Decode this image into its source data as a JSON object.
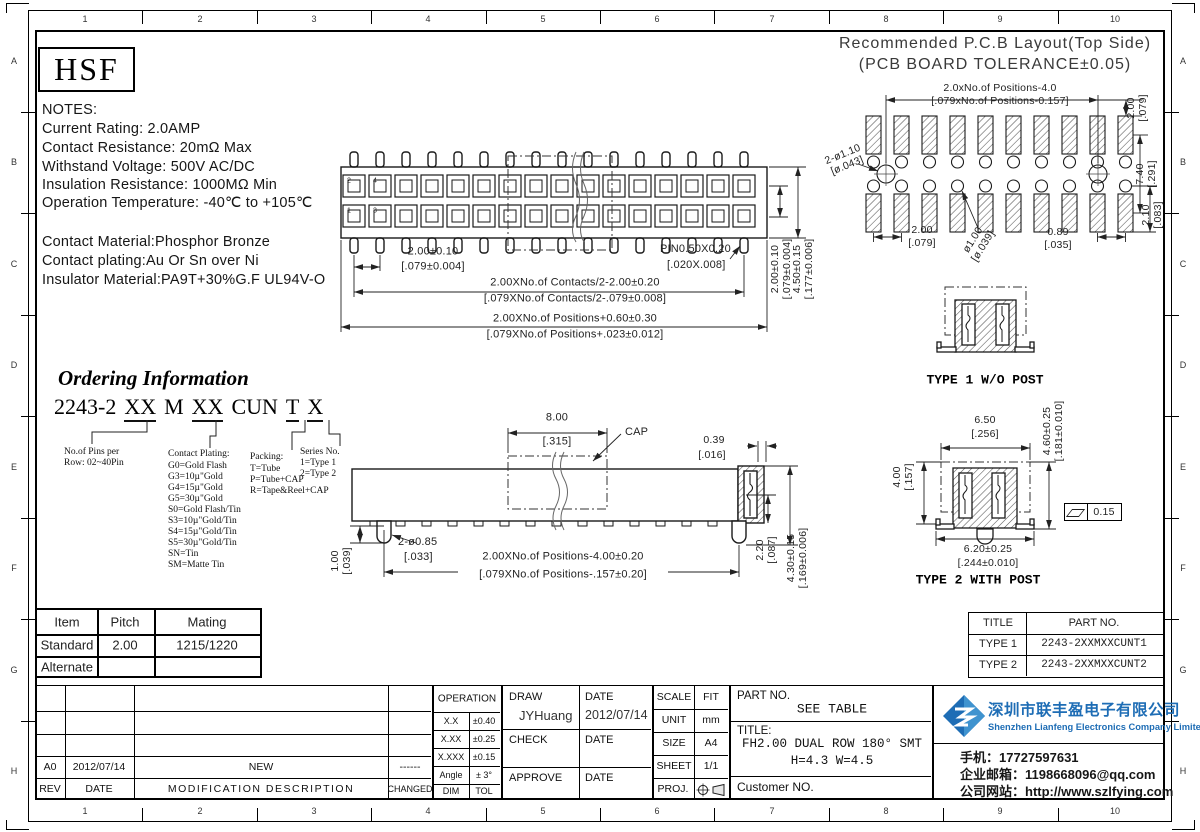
{
  "frame": {
    "cols": [
      "1",
      "2",
      "3",
      "4",
      "5",
      "6",
      "7",
      "8",
      "9",
      "10"
    ],
    "rows": [
      "A",
      "B",
      "C",
      "D",
      "E",
      "F",
      "G",
      "H"
    ]
  },
  "logo": "HSF",
  "notes": {
    "title": "NOTES:",
    "lines": [
      "Current Rating: 2.0AMP",
      "Contact Resistance: 20mΩ Max",
      "Withstand Voltage: 500V AC/DC",
      "Insulation Resistance: 1000MΩ Min",
      "Operation Temperature: -40℃ to +105℃"
    ],
    "materials": [
      "Contact Material:Phosphor Bronze",
      "Contact plating:Au Or Sn over Ni",
      "Insulator Material:PA9T+30%G.F UL94V-O"
    ]
  },
  "pcb": {
    "title_line1": "Recommended P.C.B Layout(Top Side)",
    "title_line2": "(PCB BOARD TOLERANCE±0.05)",
    "dim_span_mm": "2.0xNo.of Positions-4.0",
    "dim_span_in": "[.079xNo.of Positions-0.157]",
    "dim_vpitch_mm": "2.00",
    "dim_vpitch_in": "[.079]",
    "dim_holes_mm": "2-ø1.10",
    "dim_holes_in": "[ø.043]",
    "dim_hole_mm": "ø1.00",
    "dim_hole_in": "[ø.039]",
    "dim_pitch_mm": "2.00",
    "dim_pitch_in": "[.079]",
    "dim_pad_mm": "0.89",
    "dim_pad_in": "[.035]",
    "dim_height_mm": "7.40",
    "dim_height_in": "[.291]",
    "dim_row_mm": "2.10",
    "dim_row_in": "[.083]"
  },
  "top_view": {
    "pin_2": "2",
    "pin_4": "4",
    "pin_1": "1",
    "pin_3": "3",
    "dim_pitch_mm": "2.00±0.10",
    "dim_pitch_in": "[.079±0.004]",
    "dim_pin": "PIN0.50X0.20",
    "dim_pin_in": "[.020X.008]",
    "dim_contacts_mm": "2.00XNo.of Contacts/2-2.00±0.20",
    "dim_contacts_in": "[.079XNo.of Contacts/2-.079±0.008]",
    "dim_positions_mm": "2.00XNo.of Positions+0.60±0.30",
    "dim_positions_in": "[.079XNo.of Positions+.023±0.012]",
    "dim_rowpitch_mm": "2.00±0.10",
    "dim_rowpitch_in": "[.079±0.004]",
    "dim_height_mm": "4.50±0.15",
    "dim_height_in": "[.177±0.006]"
  },
  "ordering": {
    "title": "Ordering Information",
    "code": [
      "2243-2",
      "XX",
      "M",
      "XX",
      "CUN",
      "T",
      "X"
    ],
    "pins_line1": "No.of Pins per",
    "pins_line2": "Row: 02~40Pin",
    "plating_title": "Contact Plating:",
    "plating": [
      "G0=Gold Flash",
      "G3=10µ\"Gold",
      "G4=15µ\"Gold",
      "G5=30µ\"Gold",
      "S0=Gold Flash/Tin",
      "S3=10µ\"Gold/Tin",
      "S4=15µ\"Gold/Tin",
      "S5=30µ\"Gold/Tin",
      "SN=Tin",
      "SM=Matte Tin"
    ],
    "packing_title": "Packing:",
    "packing": [
      "T=Tube",
      "P=Tube+CAP",
      "R=Tape&Reel+CAP"
    ],
    "series_title": "Series No.",
    "series": [
      "1=Type 1",
      "2=Type 2"
    ]
  },
  "side_view": {
    "dim_cap_mm": "8.00",
    "dim_cap_in": "[.315]",
    "cap_label": "CAP",
    "dim_gap_mm": "0.39",
    "dim_gap_in": "[.016]",
    "dim_posts": "2-ø0.85",
    "dim_posts_in": "[.033]",
    "dim_posth_mm": "1.00",
    "dim_posth_in": "[.039]",
    "dim_positions_mm": "2.00XNo.of Positions-4.00±0.20",
    "dim_positions_in": "[.079XNo.of Positions-.157±0.20]",
    "dim_h1_mm": "2.20",
    "dim_h1_in": "[.087]",
    "dim_h2_mm": "4.30±0.15",
    "dim_h2_in": "[.169±0.006]"
  },
  "types": {
    "type1_label": "TYPE 1 W/O POST",
    "type2_label": "TYPE 2 WITH POST",
    "dim_w_mm": "6.50",
    "dim_w_in": "[.256]",
    "dim_h_mm": "4.60±0.25",
    "dim_h_in": "[.181±0.010]",
    "dim_b_mm": "4.00",
    "dim_b_in": "[.157]",
    "dim_lw_mm": "6.20±0.25",
    "dim_lw_in": "[.244±0.010]",
    "flatness": "0.15"
  },
  "mating_table": {
    "headers": [
      "Item",
      "Pitch",
      "Mating"
    ],
    "rows": [
      [
        "Standard",
        "2.00",
        "1215/1220"
      ],
      [
        "Alternate",
        "",
        ""
      ]
    ]
  },
  "type_table": {
    "headers": [
      "TITLE",
      "PART NO."
    ],
    "rows": [
      [
        "TYPE 1",
        "2243-2XXMXXCUNT1"
      ],
      [
        "TYPE 2",
        "2243-2XXMXXCUNT2"
      ]
    ]
  },
  "rev_table": {
    "headers": [
      "REV",
      "DATE",
      "MODIFICATION DESCRIPTION",
      "CHANGED"
    ],
    "row": {
      "rev": "A0",
      "date": "2012/07/14",
      "desc": "NEW",
      "changed": "------"
    }
  },
  "tol_table": {
    "title": "OPERATION",
    "rows": [
      [
        "X.X",
        "±0.40"
      ],
      [
        "X.XX",
        "±0.25"
      ],
      [
        "X.XXX",
        "±0.15"
      ],
      [
        "Angle",
        "± 3°"
      ],
      [
        "DIM",
        "TOL"
      ]
    ]
  },
  "sign_block": {
    "draw_label": "DRAW",
    "draw_name": "JYHuang",
    "date_label1": "DATE",
    "draw_date": "2012/07/14",
    "check_label": "CHECK",
    "date_label2": "DATE",
    "approve_label": "APPROVE",
    "date_label3": "DATE"
  },
  "info_block": {
    "scale_label": "SCALE",
    "scale": "FIT",
    "unit_label": "UNIT",
    "unit": "mm",
    "size_label": "SIZE",
    "size": "A4",
    "sheet_label": "SHEET",
    "sheet": "1/1",
    "proj_label": "PROJ."
  },
  "part_block": {
    "part_label": "PART NO.",
    "part_value": "SEE TABLE",
    "title_label": "TITLE:",
    "title_line1": "FH2.00 DUAL ROW 180° SMT",
    "title_line2": "H=4.3 W=4.5",
    "customer_label": "Customer NO."
  },
  "company": {
    "name_cn": "深圳市联丰盈电子有限公司",
    "name_en": "Shenzhen Lianfeng Electronics Company Limited",
    "phone": "手机：17727597631",
    "email": "企业邮箱：1198668096@qq.com",
    "website": "公司网站：http://www.szlfying.com",
    "brand_color": "#1e6db5"
  }
}
